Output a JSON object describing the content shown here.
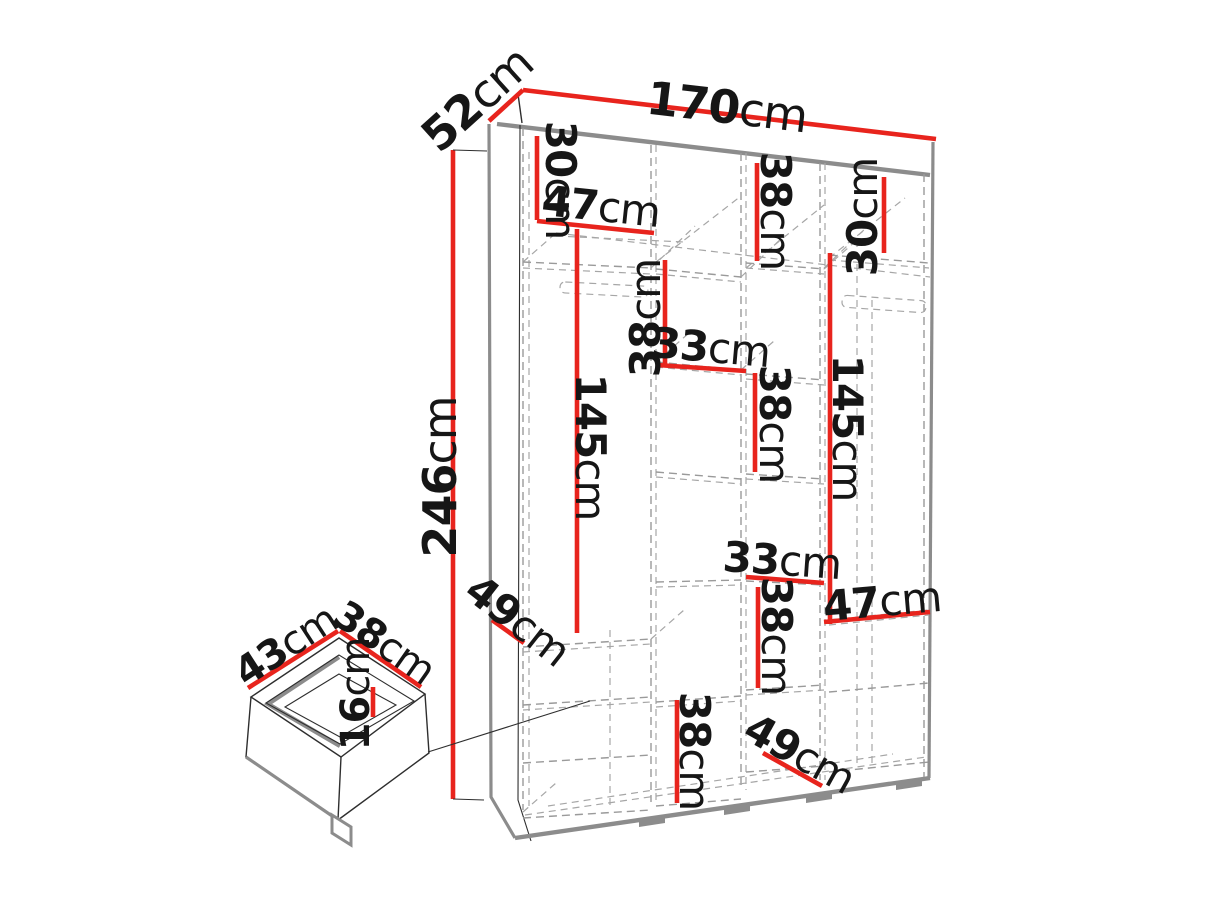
{
  "diagram": {
    "subject": "wardrobe-internal-dimensions",
    "colors": {
      "dimension_line": "#e8241d",
      "outline": "#2e2e2e",
      "hidden_line": "#9a9a9a",
      "panel_gray": "#8c8c8c",
      "background": "#ffffff",
      "text": "#161616"
    }
  },
  "labels": {
    "overall_width": {
      "num": "170",
      "unit": "cm"
    },
    "overall_depth": {
      "num": "52",
      "unit": "cm"
    },
    "overall_height": {
      "num": "246",
      "unit": "cm"
    },
    "top_left_30": {
      "num": "30",
      "unit": "cm"
    },
    "top_left_47": {
      "num": "47",
      "unit": "cm"
    },
    "top_center_38": {
      "num": "38",
      "unit": "cm"
    },
    "top_right_30": {
      "num": "30",
      "unit": "cm"
    },
    "mid_left_38": {
      "num": "38",
      "unit": "cm"
    },
    "mid_33": {
      "num": "33",
      "unit": "cm"
    },
    "mid_right_38": {
      "num": "38",
      "unit": "cm"
    },
    "left_145": {
      "num": "145",
      "unit": "cm"
    },
    "right_145": {
      "num": "145",
      "unit": "cm"
    },
    "lower_33": {
      "num": "33",
      "unit": "cm"
    },
    "lower_right_38": {
      "num": "38",
      "unit": "cm"
    },
    "right_47": {
      "num": "47",
      "unit": "cm"
    },
    "bottom_38": {
      "num": "38",
      "unit": "cm"
    },
    "left_49": {
      "num": "49",
      "unit": "cm"
    },
    "bottom_49": {
      "num": "49",
      "unit": "cm"
    },
    "drawer_43": {
      "num": "43",
      "unit": "cm"
    },
    "drawer_38": {
      "num": "38",
      "unit": "cm"
    },
    "drawer_16": {
      "num": "16",
      "unit": "cm"
    }
  }
}
